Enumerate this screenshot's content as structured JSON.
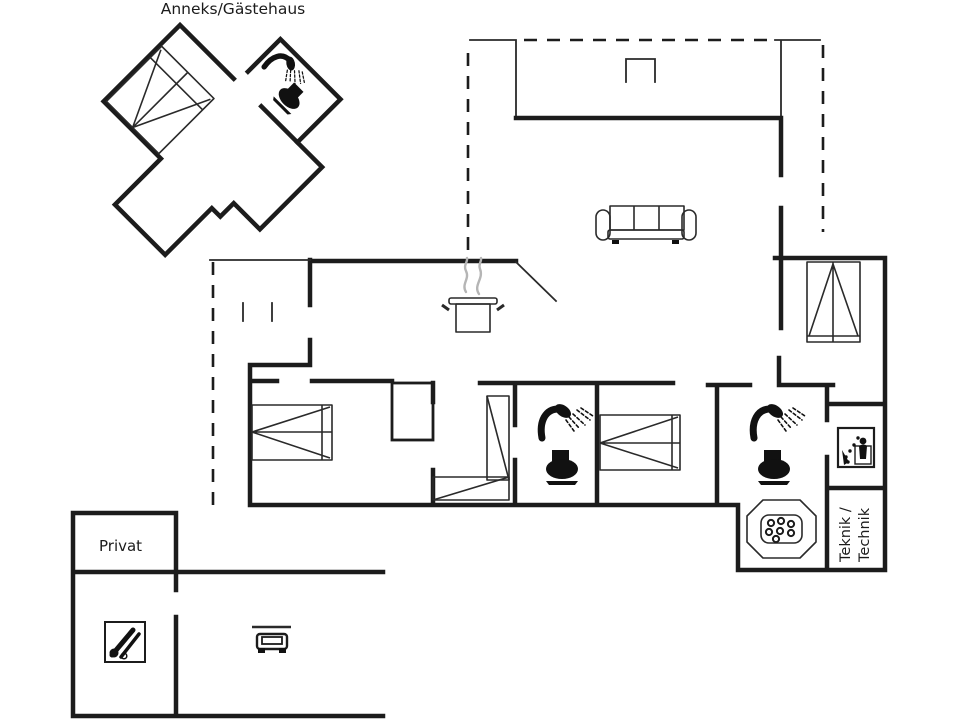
{
  "labels": {
    "annex": "Anneks/Gästehaus",
    "private_room": "Privat",
    "technical_room_line1": "Teknik /",
    "technical_room_line2": "Technik"
  },
  "colors": {
    "wall": "#1c1c1c",
    "line": "#2a2a2a",
    "steam": "#b5b5b5",
    "background": "#ffffff"
  },
  "icons": {
    "double_bed": "double-bed-icon",
    "bunk_bed": "bunk-bed-icon",
    "sofa": "sofa-icon",
    "cooking_pot": "cooking-pot-icon",
    "shower": "shower-icon",
    "toilet": "toilet-icon",
    "hot_tub": "hot-tub-icon",
    "washing_machine": "washing-machine-icon",
    "car": "car-icon",
    "garden_tools": "garden-tools-icon",
    "grill": "grill-icon"
  }
}
